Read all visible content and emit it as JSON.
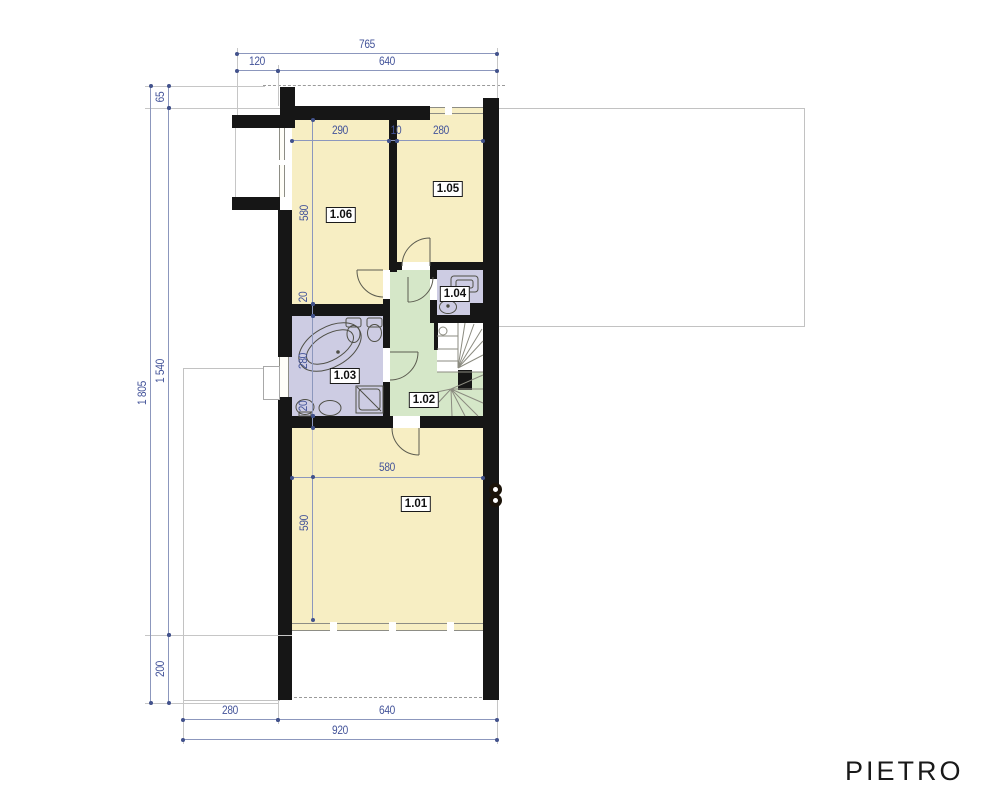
{
  "plan": {
    "title": "PIETRO",
    "rooms": {
      "r101": "1.01",
      "r102": "1.02",
      "r103": "1.03",
      "r104": "1.04",
      "r105": "1.05",
      "r106": "1.06"
    },
    "dims": {
      "top_total": "765",
      "top_seg1": "120",
      "top_seg2": "640",
      "left_total": "1 805",
      "left_seg1": "65",
      "left_seg2": "1 540",
      "left_seg3": "200",
      "r106_width": "290",
      "partition": "10",
      "r105_width": "280",
      "r106_depth": "580",
      "wall20_top": "20",
      "r103_depth": "280",
      "wall20_bottom": "20",
      "r101_width": "580",
      "r101_depth": "590",
      "bottom_seg1": "280",
      "bottom_seg2": "640",
      "bottom_total": "920"
    },
    "colors": {
      "wall": "#161616",
      "room_fill_yellow": "#f7eec3",
      "hall_fill_green": "#d5e7c8",
      "bath_fill_purple": "#cdcce3",
      "dimension_blue": "#44549a"
    }
  }
}
